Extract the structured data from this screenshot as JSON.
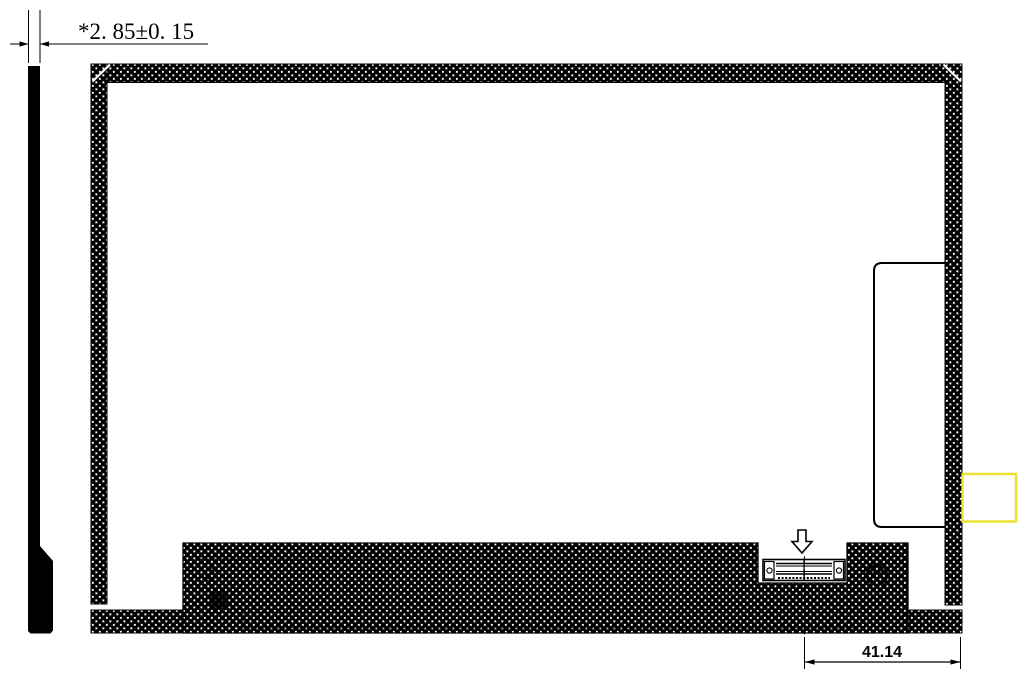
{
  "labels": {
    "thickness_dimension": "*2. 85±0. 15",
    "connector_offset_dimension": "41.14"
  },
  "colors": {
    "line": "#000000",
    "hatch_background": "#000000",
    "hatch_dot": "#ffffff",
    "highlight_box_stroke": "#ece22c",
    "page_background": "#ffffff"
  },
  "icons": {
    "down_arrow_icon": "⇩"
  }
}
